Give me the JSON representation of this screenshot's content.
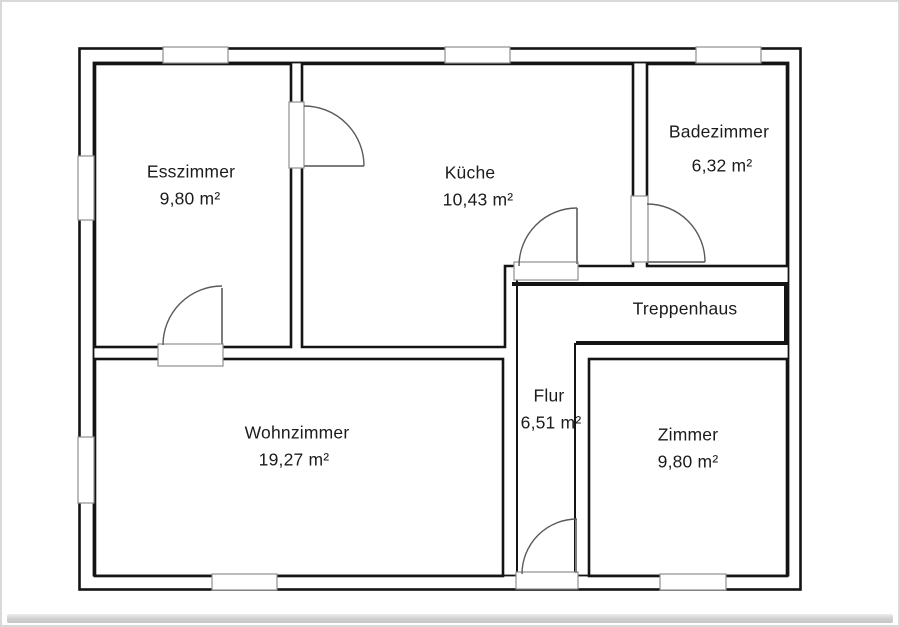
{
  "rooms": [
    {
      "id": "esszimmer",
      "name": "Esszimmer",
      "area": "9,80 m²"
    },
    {
      "id": "kueche",
      "name": "Küche",
      "area": "10,43 m²"
    },
    {
      "id": "badezimmer",
      "name": "Badezimmer",
      "area": "6,32 m²"
    },
    {
      "id": "treppenhaus",
      "name": "Treppenhaus",
      "area": ""
    },
    {
      "id": "flur",
      "name": "Flur",
      "area": "6,51 m²"
    },
    {
      "id": "wohnzimmer",
      "name": "Wohnzimmer",
      "area": "19,27 m²"
    },
    {
      "id": "zimmer",
      "name": "Zimmer",
      "area": "9,80 m²"
    }
  ],
  "colors": {
    "wall": "#141414",
    "door_arc": "#5a5a5a",
    "door_leaf": "#7d7d7d",
    "opening_jamb": "#8f8f8f",
    "text": "#1b1b1e",
    "page_shadow": "#c9c9c9"
  }
}
